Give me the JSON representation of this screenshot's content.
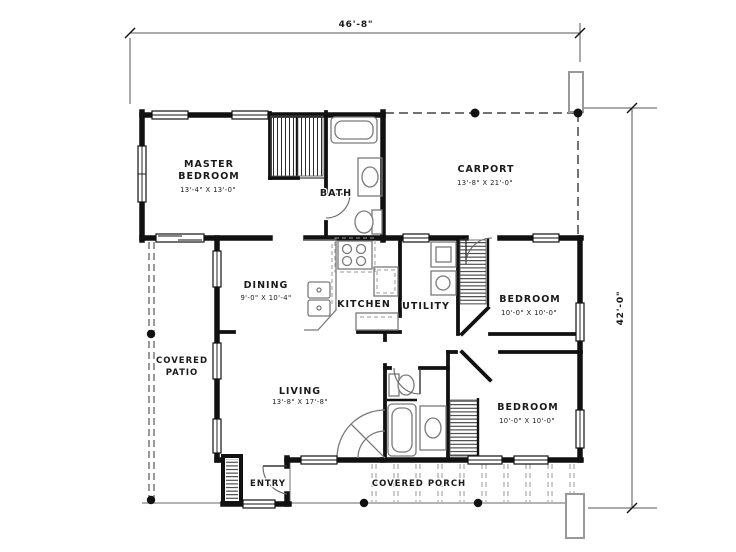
{
  "dimensions": {
    "overall_width": "46'-8\"",
    "overall_height": "42'-0\""
  },
  "rooms": {
    "master_bedroom": {
      "line1": "MASTER",
      "line2": "BEDROOM",
      "size": "13'-4\" X 13'-0\""
    },
    "bath": {
      "name": "BATH"
    },
    "carport": {
      "name": "CARPORT",
      "size": "13'-8\" X 21'-0\""
    },
    "dining": {
      "name": "DINING",
      "size": "9'-0\" X 10'-4\""
    },
    "kitchen": {
      "name": "KITCHEN"
    },
    "utility": {
      "name": "UTILITY"
    },
    "bedroom_right": {
      "name": "BEDROOM",
      "size": "10'-0\" X 10'-0\""
    },
    "bedroom_bottom": {
      "name": "BEDROOM",
      "size": "10'-0\" X 10'-0\""
    },
    "living": {
      "name": "LIVING",
      "size": "13'-8\" X 17'-8\""
    },
    "covered_patio": {
      "line1": "COVERED",
      "line2": "PATIO"
    },
    "entry": {
      "name": "ENTRY"
    },
    "covered_porch": {
      "name": "COVERED PORCH"
    }
  },
  "colors": {
    "wall": "#111111",
    "fixture": "#7a7a7a",
    "text": "#1a1a1a",
    "background": "#ffffff"
  }
}
